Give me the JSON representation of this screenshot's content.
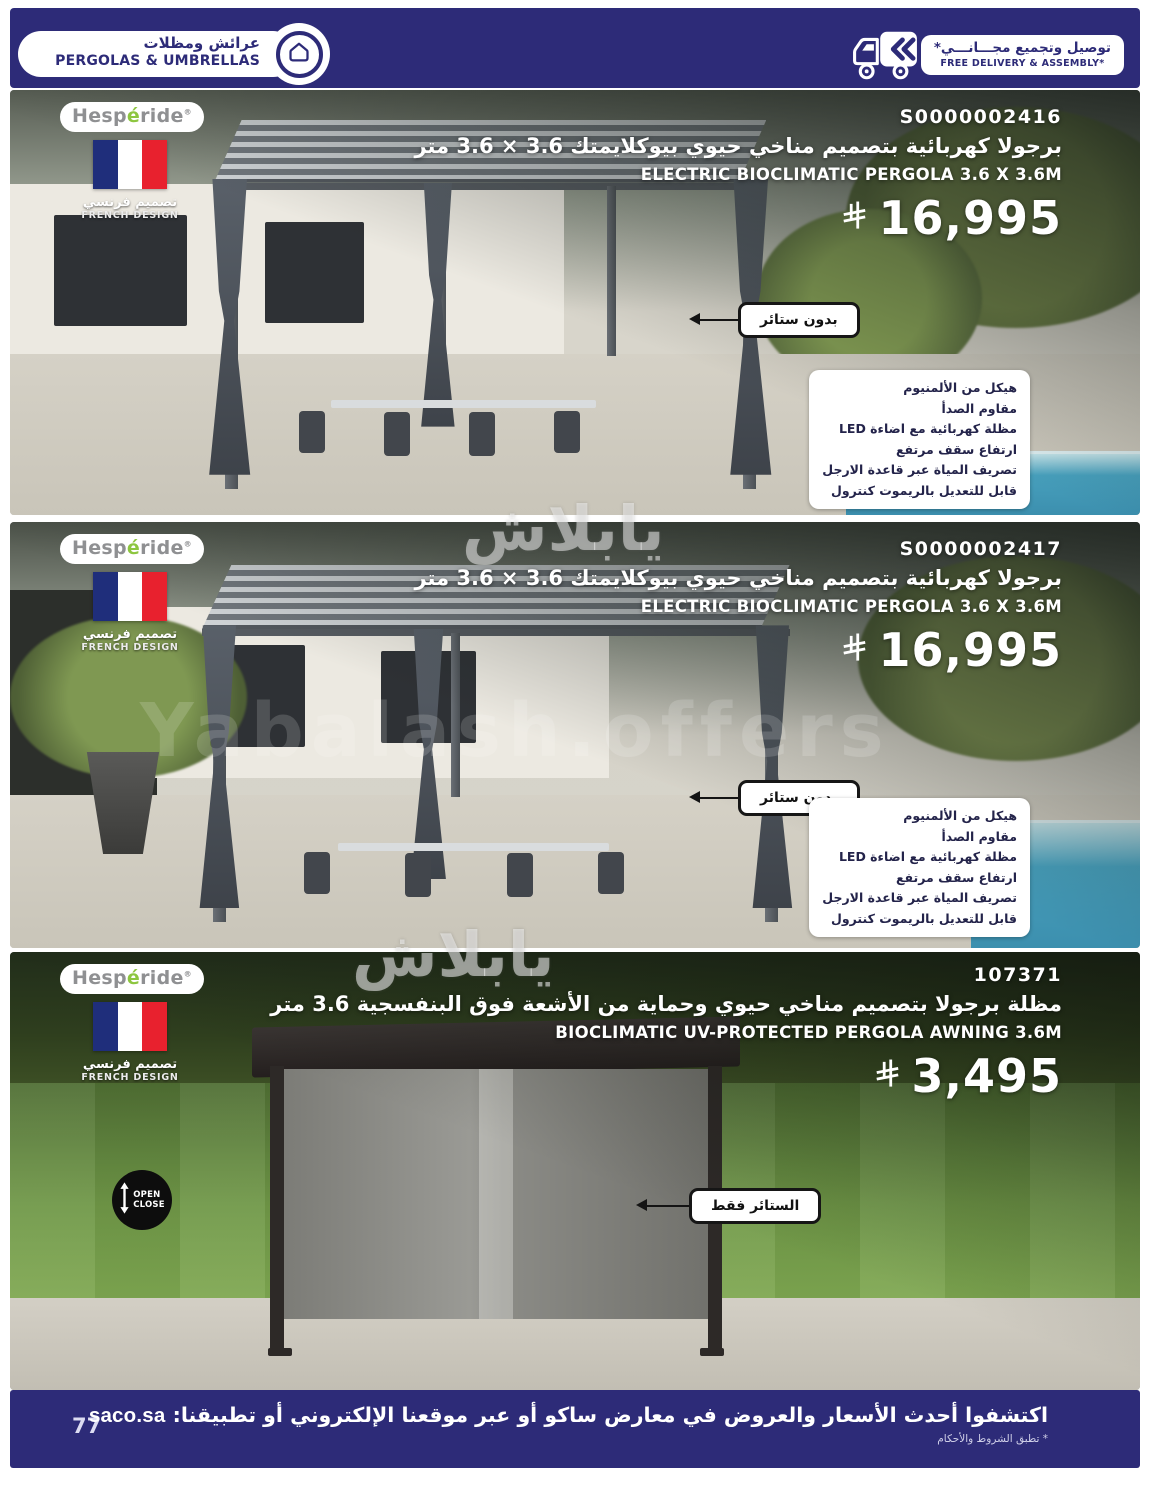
{
  "header": {
    "title_ar": "عرائش ومظلات",
    "title_en": "PERGOLAS & UMBRELLAS",
    "delivery_ar": "توصيل وتجميع مجـــانـــي*",
    "delivery_en": "FREE DELIVERY & ASSEMBLY*"
  },
  "brand": {
    "prefix": "Hesp",
    "accent": "é",
    "suffix": "ride",
    "mark": "®",
    "design_ar": "تصميم فرنسي",
    "design_en": "FRENCH DESIGN"
  },
  "features": [
    "هيكل من الألمنيوم",
    "مقاوم الصدأ",
    "مظلة كهربائية مع اضاءة LED",
    "ارتفاع سقف مرتفع",
    "تصريف المياة عبر قاعدة الارجل",
    "قابل للتعديل بالريموت كنترول"
  ],
  "products": [
    {
      "sku": "S0000002416",
      "title_ar": "برجولا كهربائية بتصميم مناخي حيوي بيوكلايمتك 3.6 × 3.6 متر",
      "title_en": "ELECTRIC BIOCLIMATIC PERGOLA 3.6 X 3.6M",
      "price": "16,995",
      "callout": "بدون ستائر"
    },
    {
      "sku": "S0000002417",
      "title_ar": "برجولا كهربائية بتصميم مناخي حيوي بيوكلايمتك 3.6 × 3.6 متر",
      "title_en": "ELECTRIC BIOCLIMATIC PERGOLA 3.6 X 3.6M",
      "price": "16,995",
      "callout": "بدون ستائر"
    },
    {
      "sku": "107371",
      "title_ar": "مظلة برجولا بتصميم مناخي حيوي وحماية من الأشعة فوق البنفسجية 3.6 متر",
      "title_en": "BIOCLIMATIC UV-PROTECTED PERGOLA AWNING 3.6M",
      "price": "3,495",
      "callout": "الستائر فقط",
      "open_label": "OPEN",
      "close_label": "CLOSE"
    }
  ],
  "footer": {
    "text": "اكتشفوا أحدث الأسعار والعروض في معارض ساكو أو عبر موقعنا الإلكتروني أو تطبيقنا:",
    "site": "saco.sa",
    "terms": "* تطبق الشروط والأحكام",
    "page_number": "77"
  },
  "watermark": {
    "arabic": "يابلاش",
    "latin": "Yabalash.offers"
  },
  "colors": {
    "navy": "#2d2b78",
    "brand_green": "#8dc63f",
    "flag_blue": "#1f2e7b",
    "flag_red": "#e8212e"
  }
}
